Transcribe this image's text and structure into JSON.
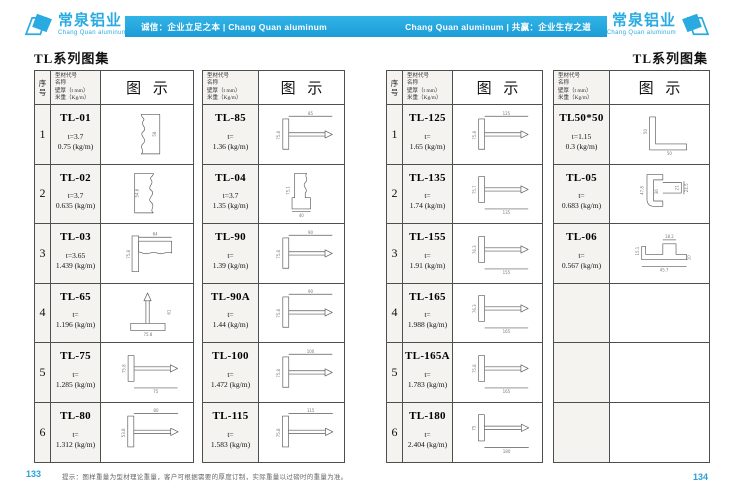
{
  "brand": {
    "logo_cn": "常泉铝业",
    "logo_en": "Chang Quan aluminum",
    "accent_color": "#29abe2"
  },
  "banner": {
    "left_text": "诚信：企业立足之本 | Chang Quan aluminum",
    "right_text": "Chang Quan aluminum | 共赢：企业生存之道"
  },
  "pages": {
    "left": {
      "title": "TL系列图集",
      "number": "133"
    },
    "right": {
      "title": "TL系列图集",
      "number": "134"
    }
  },
  "footer_note": "提示：图样重量为型材理论重量，客户可根据需要的厚度订制，实际重量以过磅时的重量为准。",
  "table_header": {
    "seq": "序\n号",
    "spec_lines": [
      "型材代号",
      "名称",
      "壁厚（t mm）",
      "米重（Kg/m）"
    ],
    "diagram": "图 示"
  },
  "tables": [
    {
      "has_seq": true,
      "rows": [
        {
          "seq": "1",
          "code": "TL-01",
          "thickness": "t=3.7",
          "weight": "0.75 (kg/m)",
          "drawing": {
            "paths": [
              "M46 8 H74 V68 H46 C52 63 42 58 49 52 C57 46 41 40 49 34 C56 29 44 24 49 18 C53 14 44 12 46 8 Z"
            ],
            "labels": [
              {
                "t": "58",
                "x": 68,
                "y": 38,
                "r": -90
              }
            ]
          }
        },
        {
          "seq": "2",
          "code": "TL-02",
          "thickness": "t=3.7",
          "weight": "0.635 (kg/m)",
          "drawing": {
            "paths": [
              "M36 8 H64 C66 12 57 14 61 18 C66 24 54 29 61 34 C69 40 53 46 61 52 C68 58 58 63 64 68 H36 Z"
            ],
            "labels": [
              {
                "t": "54.6",
                "x": 42,
                "y": 38,
                "r": -90
              }
            ]
          }
        },
        {
          "seq": "3",
          "code": "TL-03",
          "thickness": "t=3.65",
          "weight": "1.439 (kg/m)",
          "drawing": {
            "paths": [
              "M32 12 H42 V66 H32 Z",
              "M42 20 H92 V38 C84 34 78 42 70 38 C62 34 56 42 48 38 L42 36 Z",
              "M42 14 H92"
            ],
            "labels": [
              {
                "t": "64",
                "x": 67,
                "y": 11
              },
              {
                "t": "75.8",
                "x": 29,
                "y": 40,
                "r": -90
              }
            ]
          }
        },
        {
          "seq": "4",
          "code": "TL-65",
          "thickness": "t=",
          "weight": "1.196 (kg/m)",
          "drawing": {
            "paths": [
              "M30 55 H82 V66 H30 Z",
              "M53 55 V20",
              "M58 55 V20",
              "M55.5 9 L50 21 H61 Z"
            ],
            "labels": [
              {
                "t": "75.8",
                "x": 56,
                "y": 74
              },
              {
                "t": "61",
                "x": 90,
                "y": 38,
                "r": -90
              }
            ]
          }
        },
        {
          "seq": "5",
          "code": "TL-75",
          "thickness": "t=",
          "weight": "1.285 (kg/m)",
          "drawing": {
            "paths": [
              "M26 13 H35 V52 H26 Z",
              "M35 30 H90",
              "M35 35 H90",
              "M90 27 L101 32.5 L90 38 Z",
              "M35 62 H101"
            ],
            "labels": [
              {
                "t": "75",
                "x": 68,
                "y": 70
              },
              {
                "t": "75.8",
                "x": 22,
                "y": 33,
                "r": -90
              }
            ]
          }
        },
        {
          "seq": "6",
          "code": "TL-80",
          "thickness": "t=",
          "weight": "1.312 (kg/m)",
          "drawing": {
            "paths": [
              "M26 15 H35 V61 H26 Z",
              "M35 36 H90",
              "M35 41 H90",
              "M90 33 L101 38.5 L90 44 Z",
              "M35 11 H101"
            ],
            "labels": [
              {
                "t": "80",
                "x": 68,
                "y": 9
              },
              {
                "t": "53.8",
                "x": 22,
                "y": 40,
                "r": -90
              }
            ]
          }
        }
      ]
    },
    {
      "has_seq": false,
      "rows": [
        {
          "code": "TL-85",
          "thickness": "t=",
          "weight": "1.36 (kg/m)",
          "drawing": {
            "paths": [
              "M26 15 H35 V61 H26 Z",
              "M35 36 H90",
              "M35 41 H90",
              "M90 33 L101 38.5 L90 44 Z",
              "M35 11 H101"
            ],
            "labels": [
              {
                "t": "85",
                "x": 68,
                "y": 9
              },
              {
                "t": "75.8",
                "x": 22,
                "y": 40,
                "r": -90
              }
            ]
          }
        },
        {
          "code": "TL-04",
          "thickness": "t=3.7",
          "weight": "1.35 (kg/m)",
          "drawing": {
            "paths": [
              "M44 8 H62 C58 13 66 17 60 22 C54 28 66 32 60 38 L60 45 H68 V62 H40 V45 H44 Z",
              "M40 66 H68"
            ],
            "labels": [
              {
                "t": "75.1",
                "x": 36,
                "y": 34,
                "r": -90
              },
              {
                "t": "40",
                "x": 54,
                "y": 74
              }
            ]
          }
        },
        {
          "code": "TL-90",
          "thickness": "t=",
          "weight": "1.39 (kg/m)",
          "drawing": {
            "paths": [
              "M26 15 H35 V61 H26 Z",
              "M35 36 H90",
              "M35 41 H90",
              "M90 33 L101 38.5 L90 44 Z",
              "M35 11 H101"
            ],
            "labels": [
              {
                "t": "90",
                "x": 68,
                "y": 9
              },
              {
                "t": "75.8",
                "x": 22,
                "y": 40,
                "r": -90
              }
            ]
          }
        },
        {
          "code": "TL-90A",
          "thickness": "t=",
          "weight": "1.44 (kg/m)",
          "drawing": {
            "paths": [
              "M26 15 H35 V61 H26 Z",
              "M35 36 H90",
              "M35 41 H90",
              "M90 33 L101 38.5 L90 44 Z",
              "M35 11 H101"
            ],
            "labels": [
              {
                "t": "90",
                "x": 68,
                "y": 9
              },
              {
                "t": "75.8",
                "x": 22,
                "y": 40,
                "r": -90
              }
            ]
          }
        },
        {
          "code": "TL-100",
          "thickness": "t=",
          "weight": "1.472 (kg/m)",
          "drawing": {
            "paths": [
              "M26 15 H35 V61 H26 Z",
              "M35 36 H90",
              "M35 41 H90",
              "M90 33 L101 38.5 L90 44 Z",
              "M35 11 H101"
            ],
            "labels": [
              {
                "t": "100",
                "x": 68,
                "y": 9
              },
              {
                "t": "75.8",
                "x": 22,
                "y": 40,
                "r": -90
              }
            ]
          }
        },
        {
          "code": "TL-115",
          "thickness": "t=",
          "weight": "1.583 (kg/m)",
          "drawing": {
            "paths": [
              "M26 15 H35 V61 H26 Z",
              "M35 36 H90",
              "M35 41 H90",
              "M90 33 L101 38.5 L90 44 Z",
              "M35 11 H101"
            ],
            "labels": [
              {
                "t": "115",
                "x": 68,
                "y": 9
              },
              {
                "t": "75.8",
                "x": 22,
                "y": 40,
                "r": -90
              }
            ]
          }
        }
      ]
    },
    {
      "has_seq": true,
      "rows": [
        {
          "seq": "1",
          "code": "TL-125",
          "thickness": "t=",
          "weight": "1.65 (kg/m)",
          "drawing": {
            "paths": [
              "M26 15 H35 V61 H26 Z",
              "M35 36 H90",
              "M35 41 H90",
              "M90 33 L101 38.5 L90 44 Z",
              "M35 11 H101"
            ],
            "labels": [
              {
                "t": "125",
                "x": 68,
                "y": 9
              },
              {
                "t": "75.8",
                "x": 22,
                "y": 40,
                "r": -90
              }
            ]
          }
        },
        {
          "seq": "2",
          "code": "TL-135",
          "thickness": "t=",
          "weight": "1.74 (kg/m)",
          "drawing": {
            "paths": [
              "M26 13 H35 V52 H26 Z",
              "M35 30 H90",
              "M35 35 H90",
              "M90 27 L101 32.5 L90 38 Z",
              "M35 62 H101"
            ],
            "labels": [
              {
                "t": "135",
                "x": 68,
                "y": 70
              },
              {
                "t": "75.7",
                "x": 22,
                "y": 33,
                "r": -90
              }
            ]
          }
        },
        {
          "seq": "3",
          "code": "TL-155",
          "thickness": "t=",
          "weight": "1.91 (kg/m)",
          "drawing": {
            "paths": [
              "M26 13 H35 V52 H26 Z",
              "M35 30 H90",
              "M35 35 H90",
              "M90 27 L101 32.5 L90 38 Z",
              "M35 62 H101"
            ],
            "labels": [
              {
                "t": "155",
                "x": 68,
                "y": 70
              },
              {
                "t": "76.3",
                "x": 22,
                "y": 33,
                "r": -90
              }
            ]
          }
        },
        {
          "seq": "4",
          "code": "TL-165",
          "thickness": "t=",
          "weight": "1.988 (kg/m)",
          "drawing": {
            "paths": [
              "M26 13 H35 V52 H26 Z",
              "M35 30 H90",
              "M35 35 H90",
              "M90 27 L101 32.5 L90 38 Z",
              "M35 62 H101"
            ],
            "labels": [
              {
                "t": "165",
                "x": 68,
                "y": 70
              },
              {
                "t": "76.3",
                "x": 22,
                "y": 33,
                "r": -90
              }
            ]
          }
        },
        {
          "seq": "5",
          "code": "TL-165A",
          "thickness": "t=",
          "weight": "1.783 (kg/m)",
          "drawing": {
            "paths": [
              "M26 13 H35 V52 H26 Z",
              "M35 30 H90",
              "M35 35 H90",
              "M90 27 L101 32.5 L90 38 Z",
              "M35 62 H101"
            ],
            "labels": [
              {
                "t": "165",
                "x": 68,
                "y": 70
              },
              {
                "t": "75.8",
                "x": 22,
                "y": 33,
                "r": -90
              }
            ]
          }
        },
        {
          "seq": "6",
          "code": "TL-180",
          "thickness": "t=",
          "weight": "2.404 (kg/m)",
          "drawing": {
            "paths": [
              "M26 13 H35 V52 H26 Z",
              "M35 30 H90",
              "M35 35 H90",
              "M90 27 L101 32.5 L90 38 Z",
              "M35 62 H101"
            ],
            "labels": [
              {
                "t": "180",
                "x": 68,
                "y": 70
              },
              {
                "t": "75",
                "x": 22,
                "y": 33,
                "r": -90
              }
            ]
          }
        }
      ]
    },
    {
      "has_seq": false,
      "rows": [
        {
          "code": "TL50*50",
          "thickness": "t=1.15",
          "weight": "0.3 (kg/m)",
          "drawing": {
            "paths": [
              "M40 12 V62 H96 V53 H49 V12 Z"
            ],
            "labels": [
              {
                "t": "50",
                "x": 36,
                "y": 34,
                "r": -90
              },
              {
                "t": "50",
                "x": 70,
                "y": 70
              }
            ]
          }
        },
        {
          "code": "TL-05",
          "thickness": "t=",
          "weight": "0.683 (kg/m)",
          "drawing": {
            "paths": [
              "M36 10 H60 V18 H46 V50 H60 V58 H46 C40 58 36 54 36 48 Z",
              "M60 22 H88 V38 H60",
              "M92 20 V40"
            ],
            "labels": [
              {
                "t": "47.8",
                "x": 31,
                "y": 34,
                "r": -90
              },
              {
                "t": "36",
                "x": 53,
                "y": 36,
                "r": -90
              },
              {
                "t": "21",
                "x": 84,
                "y": 30,
                "r": -90
              },
              {
                "t": "24.5",
                "x": 98,
                "y": 30,
                "r": -90
              }
            ]
          }
        },
        {
          "code": "TL-06",
          "thickness": "t=",
          "weight": "0.567 (kg/m)",
          "drawing": {
            "paths": [
              "M28 28 H34 V40 H60 V24 H80 V40 H96 V48 H28 Z",
              "M28 58 H96",
              "M60 18 H80"
            ],
            "labels": [
              {
                "t": "18.2",
                "x": 70,
                "y": 15
              },
              {
                "t": "45.7",
                "x": 62,
                "y": 66
              },
              {
                "t": "15.1",
                "x": 24,
                "y": 35,
                "r": -90
              },
              {
                "t": "10",
                "x": 102,
                "y": 45,
                "r": -90
              }
            ]
          }
        },
        {
          "code": "",
          "thickness": "",
          "weight": "",
          "drawing": null
        },
        {
          "code": "",
          "thickness": "",
          "weight": "",
          "drawing": null
        },
        {
          "code": "",
          "thickness": "",
          "weight": "",
          "drawing": null
        }
      ]
    }
  ]
}
